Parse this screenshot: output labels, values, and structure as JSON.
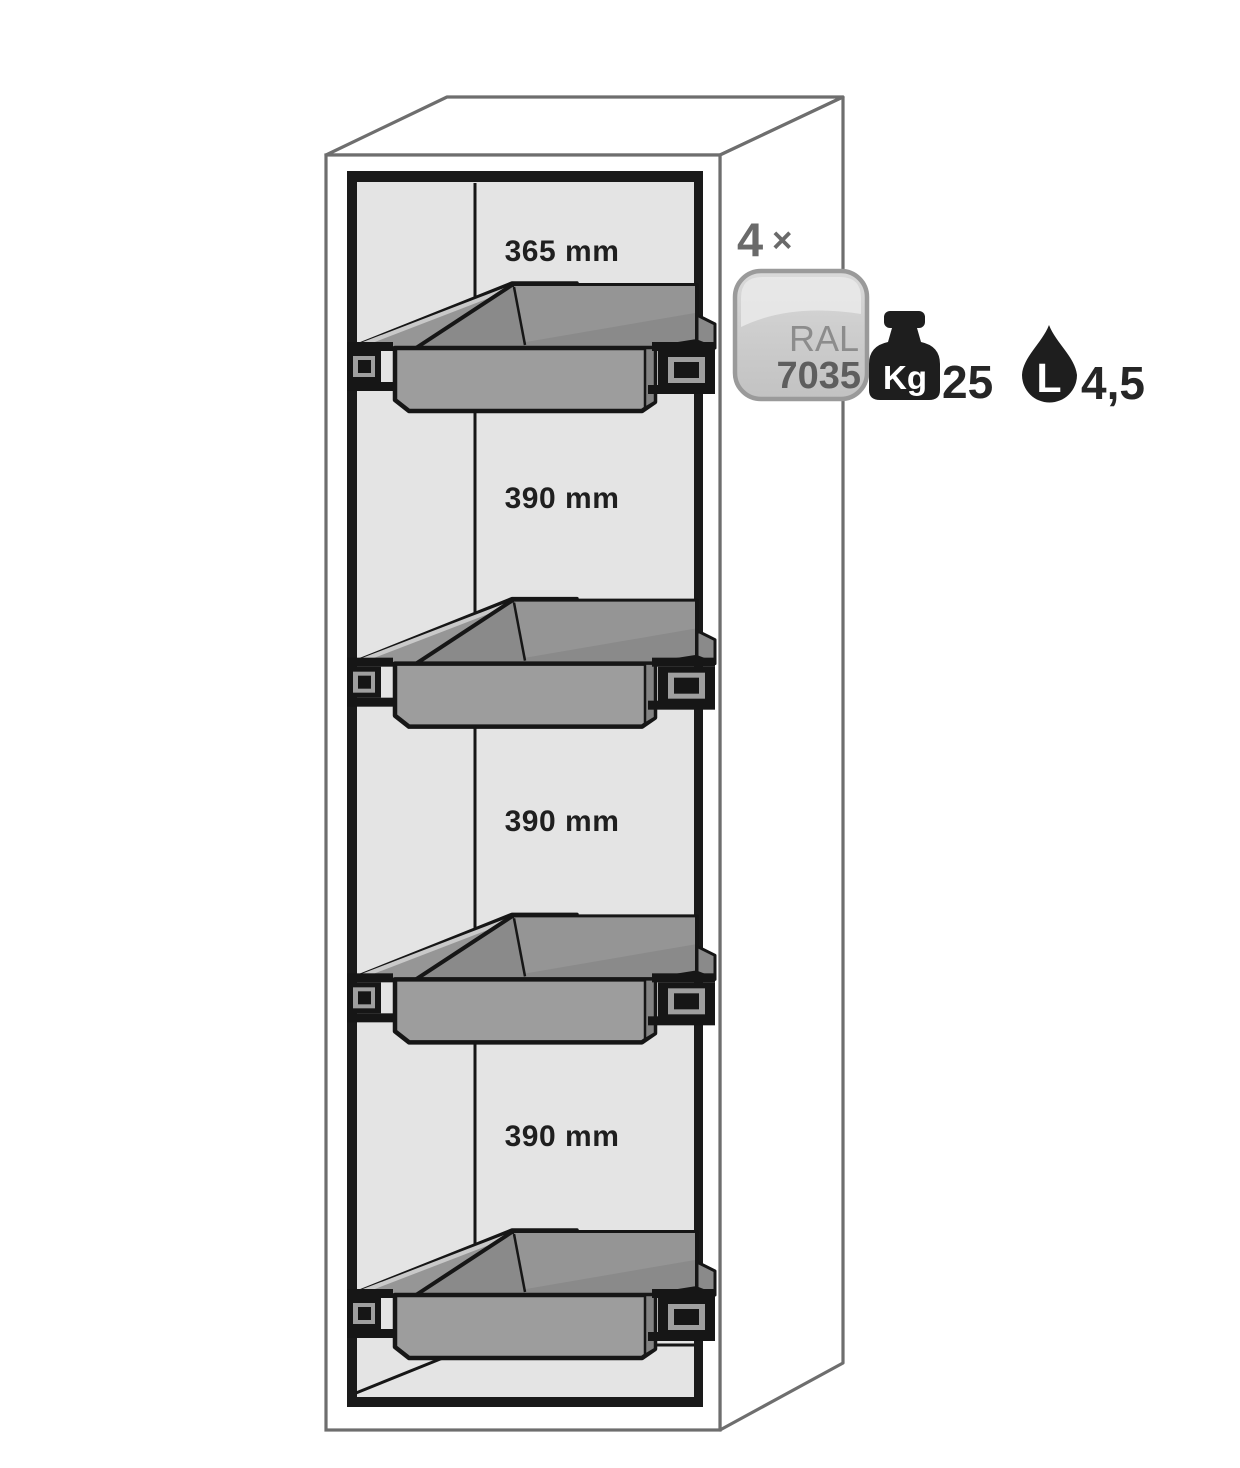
{
  "diagram": {
    "description": "Safety cabinet cutaway view with four grey pull-out shelves and capacity annotations",
    "compartments": [
      {
        "label": "365 mm"
      },
      {
        "label": "390 mm"
      },
      {
        "label": "390 mm"
      },
      {
        "label": "390 mm"
      }
    ],
    "quantity": {
      "number": "4",
      "times": "×"
    },
    "ral_badge": {
      "line1": "RAL",
      "line2": "7035"
    },
    "load_capacity": {
      "unit": "Kg",
      "value": "25"
    },
    "volume_capacity": {
      "unit": "L",
      "value": "4,5"
    },
    "colors": {
      "outline": "#6e6e6e",
      "frame": "#161616",
      "interior_wall": "#e4e4e4",
      "shelf_gray": "#9d9d9d",
      "shelf_dark": "#8a8a8a",
      "label_text": "#1f1f1f",
      "annotation_gray": "#6a6a6a",
      "badge_border": "#9a9a9a",
      "icon_black": "#1e1e1e"
    }
  }
}
